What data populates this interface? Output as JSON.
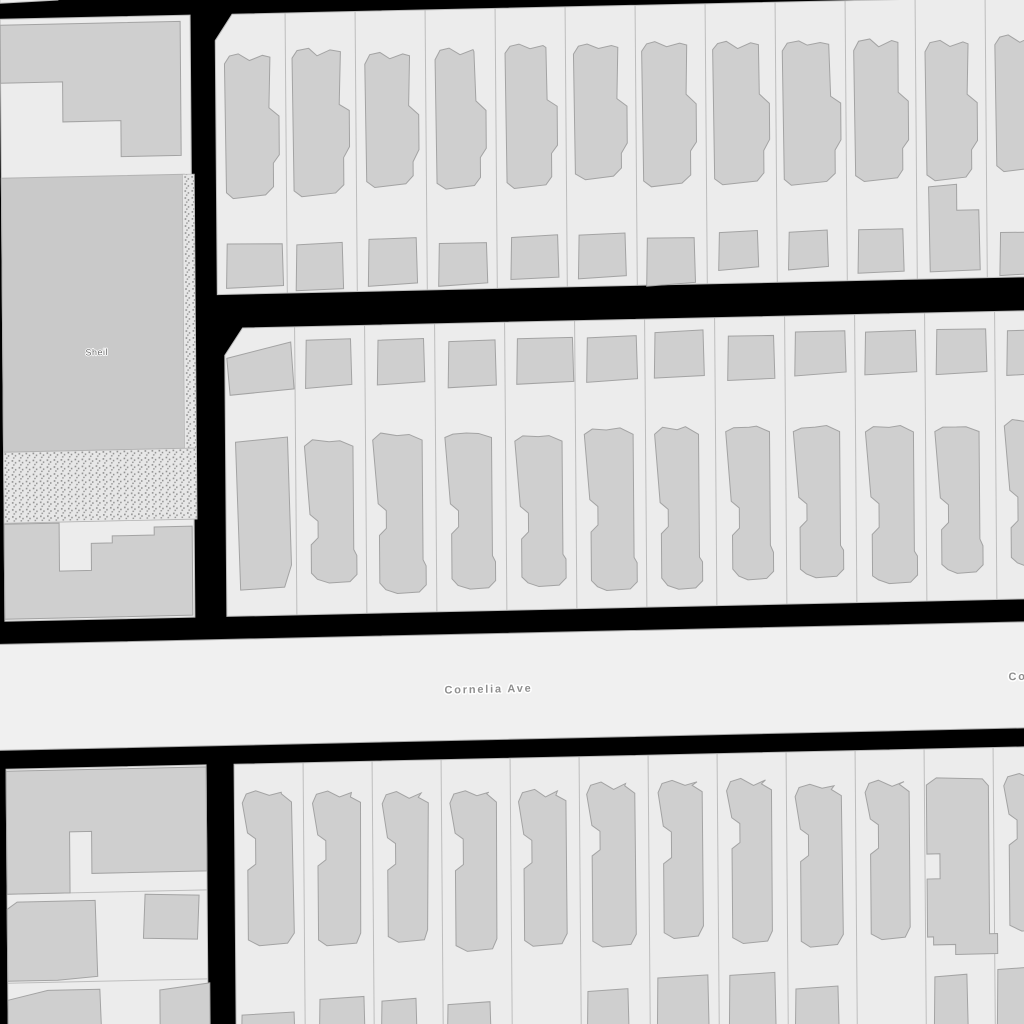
{
  "map": {
    "canvas": {
      "width": 1024,
      "height": 1024,
      "background": "#000000"
    },
    "tilt_matrix": [
      1,
      -0.022,
      0.008,
      1,
      0,
      11.3
    ],
    "colors": {
      "parcel": "#ececec",
      "parcel_border": "#bdbdbd",
      "building": "#cfcfcf",
      "building_border": "#a3a3a3",
      "park": "#c9c9c9",
      "park_border": "#b3b3b3",
      "road": "#f0f0f0",
      "road_border": "#a8a8a8",
      "stipple_bg": "#e7e7e7",
      "stipple_dot": "#8f8f8f",
      "road_label_color": "#8e8e8e",
      "park_label_color": "#6f6f6f",
      "label_halo": "#ffffff"
    },
    "labels": {
      "park": {
        "text": "Sheil",
        "x": 94,
        "y": 346,
        "size": 9,
        "spacing": 0.5,
        "weight": "400",
        "anchor": "middle"
      },
      "road": [
        {
          "text": "Cornelia Ave",
          "x": 483,
          "y": 692,
          "size": 11,
          "spacing": 1.8,
          "weight": "700",
          "anchor": "middle"
        },
        {
          "text": "Cornelia Ave",
          "x": 1003,
          "y": 691,
          "size": 11,
          "spacing": 1.8,
          "weight": "700",
          "anchor": "start"
        }
      ]
    },
    "road_band": {
      "name": "Cornelia Ave",
      "points": [
        [
          -20,
          633
        ],
        [
          1060,
          633
        ],
        [
          1060,
          739
        ],
        [
          -20,
          739
        ]
      ]
    },
    "left_column": {
      "top_sliver": [
        [
          0,
          -14
        ],
        [
          58,
          -14
        ],
        [
          58,
          -10
        ],
        [
          0,
          -8
        ]
      ],
      "upper_block": {
        "outline": [
          [
            0,
            8
          ],
          [
            190,
            8
          ],
          [
            190,
            610
          ],
          [
            0,
            610
          ]
        ],
        "park": [
          [
            0,
            167
          ],
          [
            183,
            167
          ],
          [
            183,
            441
          ],
          [
            0,
            441
          ]
        ],
        "stipple_strip": [
          [
            181,
            167
          ],
          [
            193,
            167
          ],
          [
            193,
            441
          ],
          [
            181,
            441
          ]
        ],
        "stipple_band": [
          [
            0,
            441
          ],
          [
            193,
            441
          ],
          [
            193,
            512
          ],
          [
            0,
            512
          ]
        ],
        "buildings": [
          [
            [
              0,
              14
            ],
            [
              180,
              14
            ],
            [
              180,
              148
            ],
            [
              120,
              148
            ],
            [
              120,
              112
            ],
            [
              62,
              112
            ],
            [
              62,
              72
            ],
            [
              0,
              72
            ]
          ],
          [
            [
              0,
              513
            ],
            [
              55,
              513
            ],
            [
              55,
              561
            ],
            [
              87,
              561
            ],
            [
              87,
              534
            ],
            [
              108,
              534
            ],
            [
              108,
              527
            ],
            [
              150,
              527
            ],
            [
              150,
              519
            ],
            [
              188,
              519
            ],
            [
              188,
              608
            ],
            [
              0,
              608
            ]
          ]
        ]
      },
      "lower_block": {
        "outline": [
          [
            0,
            758
          ],
          [
            200,
            758
          ],
          [
            200,
            1040
          ],
          [
            0,
            1040
          ]
        ],
        "parcel_lines_y": [
          883,
          972
        ],
        "buildings": [
          [
            [
              0,
              760
            ],
            [
              200,
              760
            ],
            [
              200,
              864
            ],
            [
              85,
              864
            ],
            [
              85,
              822
            ],
            [
              63,
              822
            ],
            [
              63,
              883
            ],
            [
              0,
              883
            ]
          ],
          [
            [
              0,
              898
            ],
            [
              10,
              891
            ],
            [
              88,
              891
            ],
            [
              90,
              967
            ],
            [
              50,
              970
            ],
            [
              0,
              970
            ]
          ],
          [
            [
              138,
              886
            ],
            [
              192,
              888
            ],
            [
              190,
              932
            ],
            [
              136,
              930
            ]
          ],
          [
            [
              0,
              989
            ],
            [
              40,
              980
            ],
            [
              92,
              980
            ],
            [
              94,
              1040
            ],
            [
              0,
              1040
            ]
          ],
          [
            [
              152,
              982
            ],
            [
              202,
              976
            ],
            [
              202,
              1040
            ],
            [
              152,
              1040
            ]
          ]
        ]
      }
    },
    "blocks": [
      {
        "id": "row-a",
        "x0": 215,
        "x1": 1055,
        "y0": 8,
        "y1": 288,
        "chamfer": [
          [
            215,
            34
          ],
          [
            232,
            8
          ]
        ],
        "pitch": 70,
        "parcels": 12,
        "seed": 20,
        "houses": {
          "style": "A",
          "top": 46,
          "bottom": 194
        },
        "garages": {
          "top": 237,
          "h": 47,
          "skip": [],
          "small": [
            7,
            8
          ],
          "lshape": [
            10
          ],
          "wide": [
            0
          ]
        }
      },
      {
        "id": "row-b",
        "x0": 222,
        "x1": 1055,
        "y0": 322,
        "y1": 610,
        "chamfer": [
          [
            222,
            349
          ],
          [
            240,
            322
          ]
        ],
        "pitch": 70,
        "parcels": 12,
        "seed": 77,
        "houses": {
          "style": "B",
          "top": 432,
          "bottom": 592,
          "notchA": 72,
          "plain0": true
        },
        "garages": {
          "top": 336,
          "h": 47,
          "skip": [],
          "small": [],
          "lshape": [],
          "wide": [
            4
          ],
          "trapezoid0": [
            [
              224,
              352
            ],
            [
              288,
              337
            ],
            [
              291,
              384
            ],
            [
              227,
              389
            ]
          ]
        }
      },
      {
        "id": "row-c",
        "x0": 228,
        "x1": 1055,
        "y0": 758,
        "y1": 1045,
        "chamfer": null,
        "pitch": 69,
        "parcels": 12,
        "seed": 140,
        "houses": {
          "style": "C",
          "top": 786,
          "bottom": 952,
          "notchA": 42,
          "wide_notch_index": 10
        },
        "wide_house": [
          [
            920,
            794
          ],
          [
            930,
            787
          ],
          [
            976,
            789
          ],
          [
            982,
            796
          ],
          [
            982,
            944
          ],
          [
            990,
            944
          ],
          [
            990,
            964
          ],
          [
            948,
            964
          ],
          [
            948,
            954
          ],
          [
            926,
            954
          ],
          [
            926,
            946
          ],
          [
            920,
            946
          ],
          [
            920,
            888
          ],
          [
            933,
            888
          ],
          [
            933,
            863
          ],
          [
            920,
            863
          ]
        ],
        "garages_custom": [
          {
            "i": 0,
            "off": 6,
            "w": 52,
            "y": 1008
          },
          {
            "i": 1,
            "off": 15,
            "w": 44,
            "y": 994
          },
          {
            "i": 2,
            "off": 8,
            "w": 34,
            "y": 997
          },
          {
            "i": 3,
            "off": 5,
            "w": 42,
            "y": 1002
          },
          {
            "i": 5,
            "off": 7,
            "w": 40,
            "y": 992
          },
          {
            "i": 6,
            "off": 8,
            "w": 50,
            "y": 980
          },
          {
            "i": 7,
            "off": 11,
            "w": 45,
            "y": 979
          },
          {
            "i": 8,
            "off": 8,
            "w": 42,
            "y": 994
          },
          {
            "i": 10,
            "off": 9,
            "w": 32,
            "y": 985
          },
          {
            "i": 11,
            "off": 3,
            "w": 40,
            "y": 979
          }
        ]
      }
    ]
  }
}
